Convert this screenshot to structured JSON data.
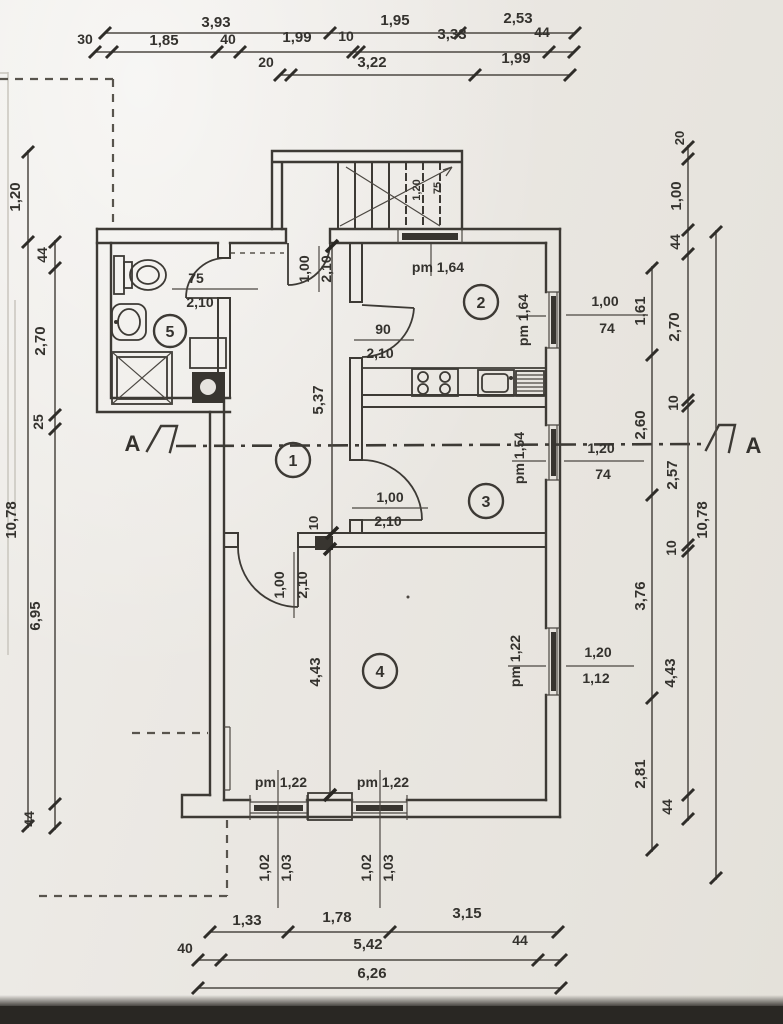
{
  "dims": {
    "top1": [
      "3,93",
      "1,95",
      "2,53"
    ],
    "top2": [
      "30",
      "1,85",
      "40",
      "1,99",
      "10",
      "3,33",
      "44"
    ],
    "top3": [
      "20",
      "3,22",
      "1,99"
    ],
    "bottom1": [
      "1,33",
      "1,78",
      "3,15"
    ],
    "bottom2": [
      "40",
      "5,42",
      "44"
    ],
    "bottom3": [
      "6,26"
    ],
    "left_outer": [
      "1,20",
      "10,78"
    ],
    "left_inner": [
      "44",
      "2,70",
      "25",
      "6,95",
      "44"
    ],
    "right_inner": [
      "1,61",
      "2,60",
      "3,76",
      "2,81"
    ],
    "right_middle": [
      "20",
      "1,00",
      "44",
      "2,70",
      "10",
      "2,57",
      "10",
      "4,43",
      "44"
    ],
    "right_outer": [
      "10,78"
    ],
    "hall_height": "5,37",
    "room4_height": "4,43",
    "wall_thickness": "10"
  },
  "rooms": [
    "1",
    "2",
    "3",
    "4",
    "5"
  ],
  "section": {
    "label": "A"
  },
  "doors": {
    "entry": [
      "1,00",
      "2,10"
    ],
    "bath": [
      "75",
      "2,10"
    ],
    "kitchen": [
      "90",
      "2,10"
    ],
    "room3": [
      "1,00",
      "2,10"
    ],
    "room4": [
      "1,00",
      "2,10"
    ]
  },
  "windows": {
    "north": "pm 1,64",
    "east1": {
      "pm": "pm 1,64",
      "w": "1,00",
      "h": "74"
    },
    "east2": {
      "pm": "pm 1,54",
      "w": "1,20",
      "h": "74"
    },
    "east3": {
      "pm": "pm 1,22",
      "w": "1,20",
      "h": "1,12"
    },
    "south1": {
      "pm": "pm 1,22",
      "a": "1,02",
      "b": "1,03"
    },
    "south2": {
      "pm": "pm 1,22",
      "a": "1,02",
      "b": "1,03"
    }
  },
  "stairs": [
    "1,20",
    "75"
  ]
}
